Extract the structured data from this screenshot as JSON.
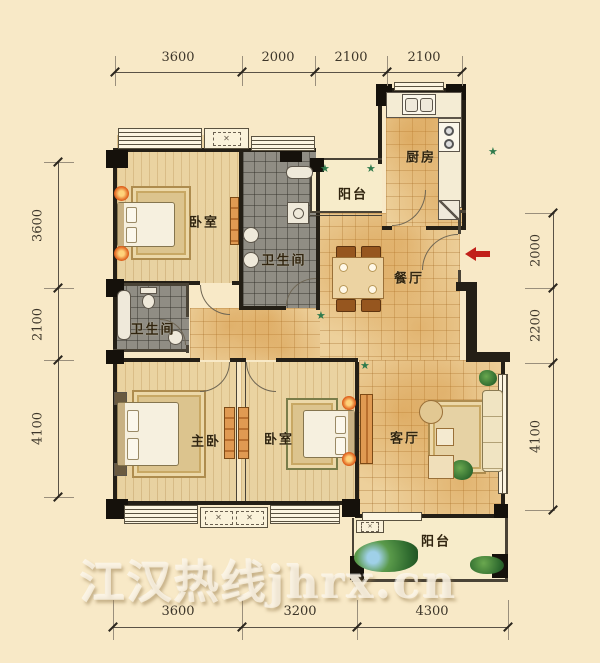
{
  "watermark": "江汉热线jhrx.cn",
  "rooms": {
    "bedroom_top": "卧室",
    "bathroom_top": "卫生间",
    "balcony_top": "阳台",
    "kitchen": "厨房",
    "dining": "餐厅",
    "bathroom_mid": "卫生间",
    "master_bedroom": "主卧",
    "bedroom_bottom": "卧室",
    "living": "客厅",
    "balcony_bottom": "阳台"
  },
  "dimensions": {
    "top": [
      "3600",
      "2000",
      "2100",
      "2100"
    ],
    "left": [
      "3600",
      "2100",
      "4100"
    ],
    "right": [
      "2000",
      "2200",
      "4100"
    ],
    "bottom": [
      "3600",
      "3200",
      "4300"
    ]
  },
  "icons": {
    "plant_star": "★",
    "ac_cross": "✕",
    "entry_arrow": "left-arrow"
  },
  "colors": {
    "background": "#f8e9c7",
    "wall": "#241f16",
    "floor_tile": "#edd09b",
    "floor_wood": "#eedcb0",
    "bath_tile": "#908d84",
    "balcony": "#f7ecca",
    "arrow_red": "#c1201a",
    "plant_green": "#2f7a4c",
    "dim_text": "#3d362a"
  }
}
